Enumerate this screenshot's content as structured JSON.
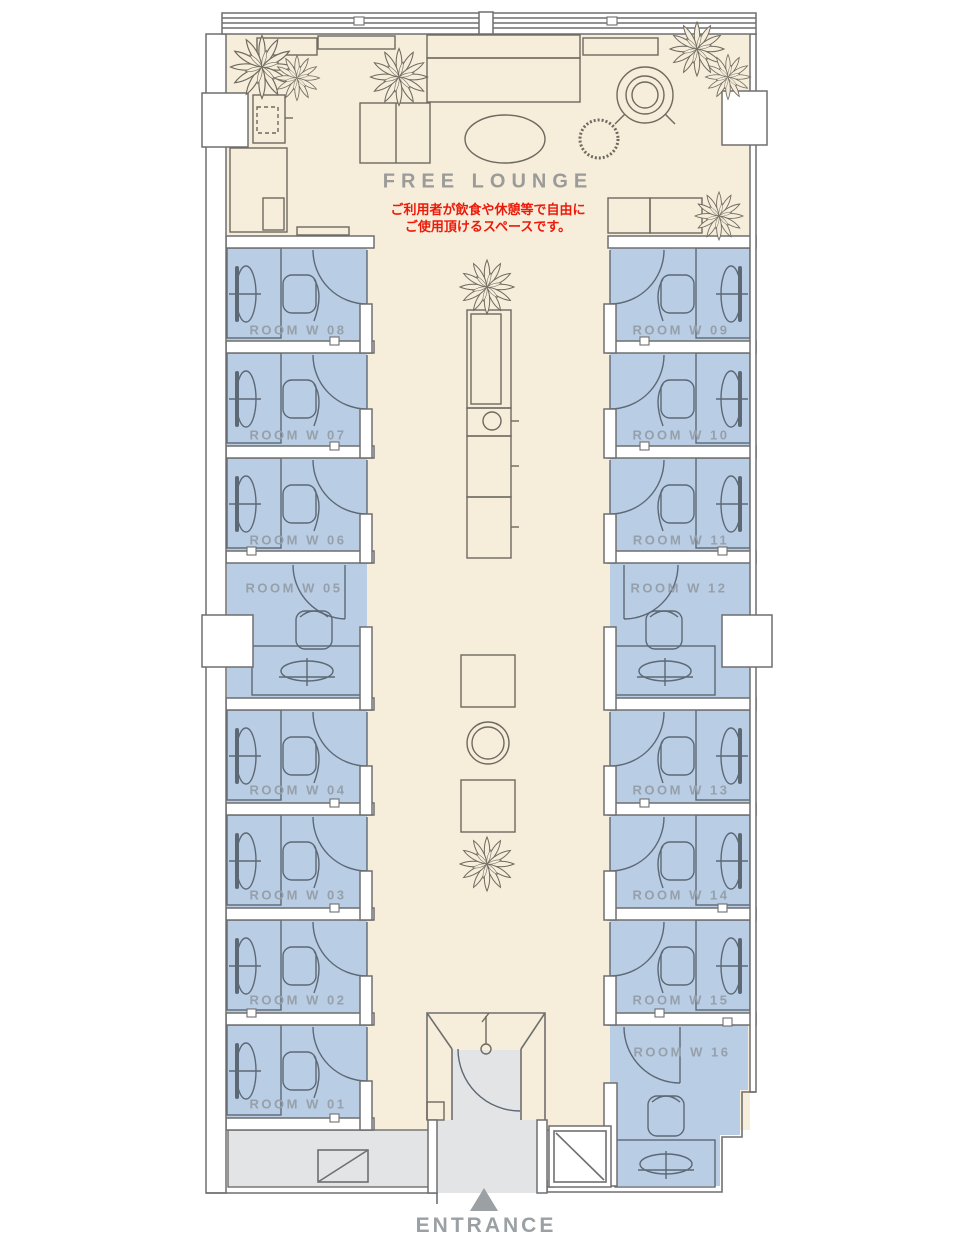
{
  "plan": {
    "lounge": {
      "label": "FREE LOUNGE",
      "note_line1": "ご利用者が飲食や休憩等で自由に",
      "note_line2": "ご使用頂けるスペースです。"
    },
    "entrance": {
      "label": "ENTRANCE",
      "arrow_icon": "triangle-up"
    },
    "rooms": [
      {
        "id": "w01",
        "label": "ROOM W 01"
      },
      {
        "id": "w02",
        "label": "ROOM W 02"
      },
      {
        "id": "w03",
        "label": "ROOM W 03"
      },
      {
        "id": "w04",
        "label": "ROOM W 04"
      },
      {
        "id": "w05",
        "label": "ROOM W 05"
      },
      {
        "id": "w06",
        "label": "ROOM W 06"
      },
      {
        "id": "w07",
        "label": "ROOM W 07"
      },
      {
        "id": "w08",
        "label": "ROOM W 08"
      },
      {
        "id": "w09",
        "label": "ROOM W 09"
      },
      {
        "id": "w10",
        "label": "ROOM W 10"
      },
      {
        "id": "w11",
        "label": "ROOM W 11"
      },
      {
        "id": "w12",
        "label": "ROOM W 12"
      },
      {
        "id": "w13",
        "label": "ROOM W 13"
      },
      {
        "id": "w14",
        "label": "ROOM W 14"
      },
      {
        "id": "w15",
        "label": "ROOM W 15"
      },
      {
        "id": "w16",
        "label": "ROOM W 16"
      }
    ]
  },
  "colors": {
    "room_fill": "#b9cde4",
    "lounge_floor": "#f6edda",
    "corridor_floor": "#e3e4e6",
    "wall_line": "#6f6f6f",
    "furniture_line": "#6e6a60",
    "room_furniture_line": "#5d6875",
    "room_label": "#96a0ab",
    "lounge_label": "#9b9b99",
    "note_red": "#ed1909",
    "entrance_label": "#9aa0a3"
  }
}
